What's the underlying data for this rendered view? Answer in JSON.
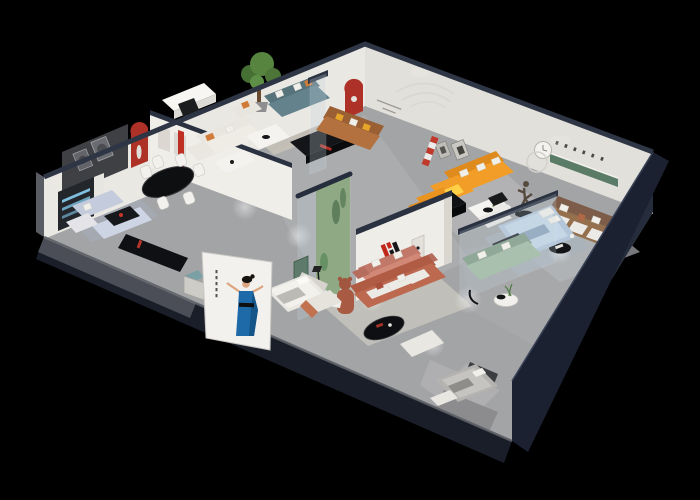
{
  "meta": {
    "type": "3d-isometric-interior-render",
    "subject": "Cutaway isometric render of a furniture showroom apartment on a black background",
    "canvas": {
      "width": 700,
      "height": 500
    }
  },
  "brand": {
    "logo_letter": "H",
    "caption": "华悦",
    "logo_red": "#c0281c",
    "logo_black": "#17171a"
  },
  "palette": {
    "background": "#000000",
    "wall_cap_navy": "#2a3140",
    "wall_white": "#efede8",
    "floor_gray": "#a3a4a6",
    "niche_red": "#ad3126",
    "shelf_green": "#5a7b66",
    "sofa_orange": "#f19d27",
    "sofa_teal": "#64828c",
    "sofa_sage": "#a9c0af",
    "sofa_terracotta": "#bc6950",
    "sofa_salmon": "#d18876",
    "sofa_caramel": "#b3713f",
    "sofa_brown": "#94704f",
    "sofa_periwinkle": "#c6cede",
    "bed_blue": "#c5d6e6",
    "billboard_dress_blue": "#1e6aa8"
  },
  "billboard": {
    "figure": "woman in blue evening dress, arms outstretched",
    "panel_color": "#f2f1ee"
  },
  "rooms": [
    {
      "name": "dining-room",
      "key_items": [
        "black oval dining table",
        "white chairs",
        "red arched niche",
        "dark art wall"
      ]
    },
    {
      "name": "home-office",
      "key_items": [
        "white desk",
        "black chair",
        "red slim lamp"
      ]
    },
    {
      "name": "white-lounge",
      "key_items": [
        "cream sofa",
        "white coffee table",
        "orange pillows"
      ]
    },
    {
      "name": "teal-living",
      "key_items": [
        "teal sofa",
        "potted tree",
        "black media console",
        "glass partition"
      ]
    },
    {
      "name": "caramel-lounge",
      "key_items": [
        "caramel leather sofa",
        "yellow pillows",
        "red arched niche",
        "wall script"
      ]
    },
    {
      "name": "orange-living",
      "key_items": [
        "orange L-sofa",
        "white two-tier coffee table",
        "runner sculpture",
        "striped wall banner"
      ]
    },
    {
      "name": "brown-lounge",
      "key_items": [
        "brown sofa",
        "green wall shelf",
        "wall clock",
        "striped rug"
      ]
    },
    {
      "name": "glass-bedroom",
      "key_items": [
        "light blue bed",
        "dark foot bench",
        "glass walls"
      ]
    },
    {
      "name": "sage-living",
      "key_items": [
        "sage green sofa",
        "round coffee table with plant"
      ]
    },
    {
      "name": "brand-corridor",
      "key_items": [
        "H logo wall",
        "glass plant display case",
        "teddy sculpture",
        "black console"
      ]
    },
    {
      "name": "salmon-lounge",
      "key_items": [
        "salmon sofa with white pillows"
      ]
    },
    {
      "name": "terracotta-living",
      "key_items": [
        "terracotta sofa",
        "black oval coffee table",
        "white bench",
        "armchair"
      ]
    },
    {
      "name": "white-bedroom",
      "key_items": [
        "white bed",
        "green cabinet",
        "floor lamp"
      ]
    },
    {
      "name": "gray-bedroom",
      "key_items": [
        "gray bed",
        "dark headboard",
        "white bench"
      ]
    },
    {
      "name": "periwinkle-living",
      "key_items": [
        "periwinkle sofas",
        "black coffee table",
        "long black console",
        "blue-lit cabinet"
      ]
    }
  ]
}
